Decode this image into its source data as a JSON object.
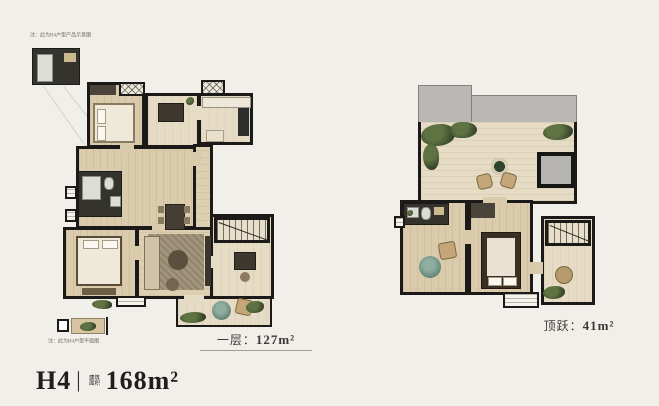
{
  "page": {
    "background_color": "#f1efe9",
    "wall_color": "#1b1a18",
    "floor_color": "#d9cbab",
    "floor_light_color": "#e6dcc5",
    "roof_color": "#b9b8b4",
    "plant_color": "#36432a",
    "rug_color": "#5d8276",
    "dark_room_color": "#34332d"
  },
  "title": {
    "model": "H4",
    "divider": "|",
    "area_label_line1": "建筑",
    "area_label_line2": "面积",
    "area_value": "168m²"
  },
  "left_plan": {
    "caption_label": "一层：",
    "caption_value": "127m²",
    "note_top": "注：此为H4户型产品示意图",
    "note_bottom": "注：此为H4户型平面图"
  },
  "right_plan": {
    "caption_label": "顶跃：",
    "caption_value": "41m²"
  }
}
